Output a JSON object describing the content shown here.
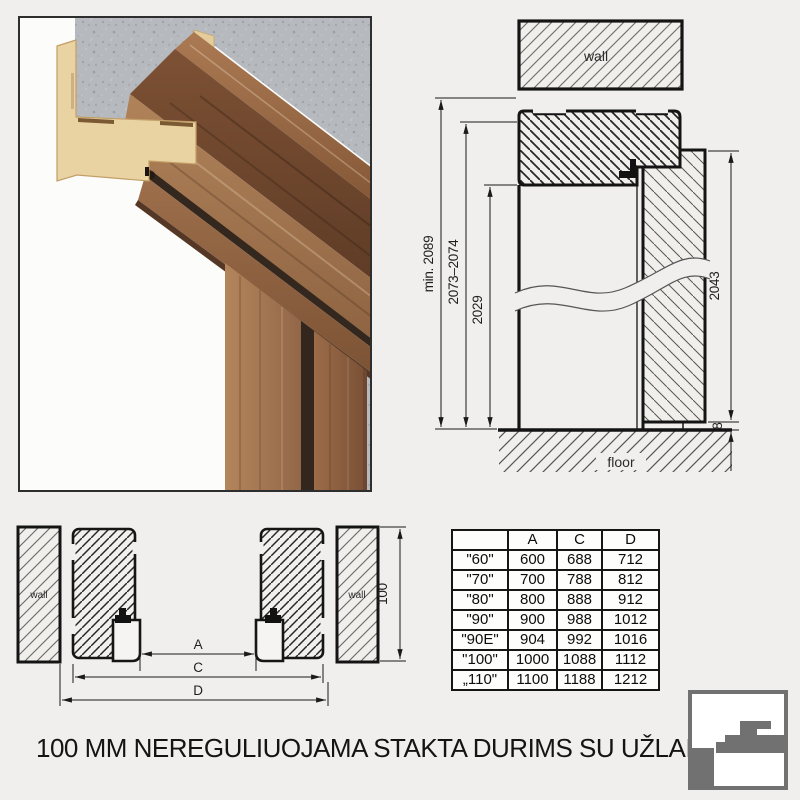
{
  "page": {
    "background": "#f0efed",
    "title": "100 MM NEREGULIUOJAMA STAKTA DURIMS SU UŽLAIDA"
  },
  "photo": {
    "concrete_color": "#b6babe",
    "mdf_color": "#e9d3a2",
    "wood_color": "#7d5134",
    "seal_color": "#33271e"
  },
  "vertical_section": {
    "wall_label": "wall",
    "floor_label": "floor",
    "dims": {
      "opening_min": "min. 2089",
      "frame_height": "2073–2074",
      "clear_height": "2029",
      "door_height": "2043",
      "floor_gap": "8"
    }
  },
  "horizontal_section": {
    "wall_left": "wall",
    "wall_right": "wall",
    "frame_depth": "100",
    "dims": {
      "a": "A",
      "c": "C",
      "d": "D"
    }
  },
  "size_table": {
    "columns": [
      "",
      "A",
      "C",
      "D"
    ],
    "rows": [
      [
        "\"60\"",
        "600",
        "688",
        "712"
      ],
      [
        "\"70\"",
        "700",
        "788",
        "812"
      ],
      [
        "\"80\"",
        "800",
        "888",
        "912"
      ],
      [
        "\"90\"",
        "900",
        "988",
        "1012"
      ],
      [
        "\"90E\"",
        "904",
        "992",
        "1016"
      ],
      [
        "\"100\"",
        "1000",
        "1088",
        "1112"
      ],
      [
        "„110\"",
        "1100",
        "1188",
        "1212"
      ]
    ]
  },
  "logo": {
    "color": "#717171"
  }
}
